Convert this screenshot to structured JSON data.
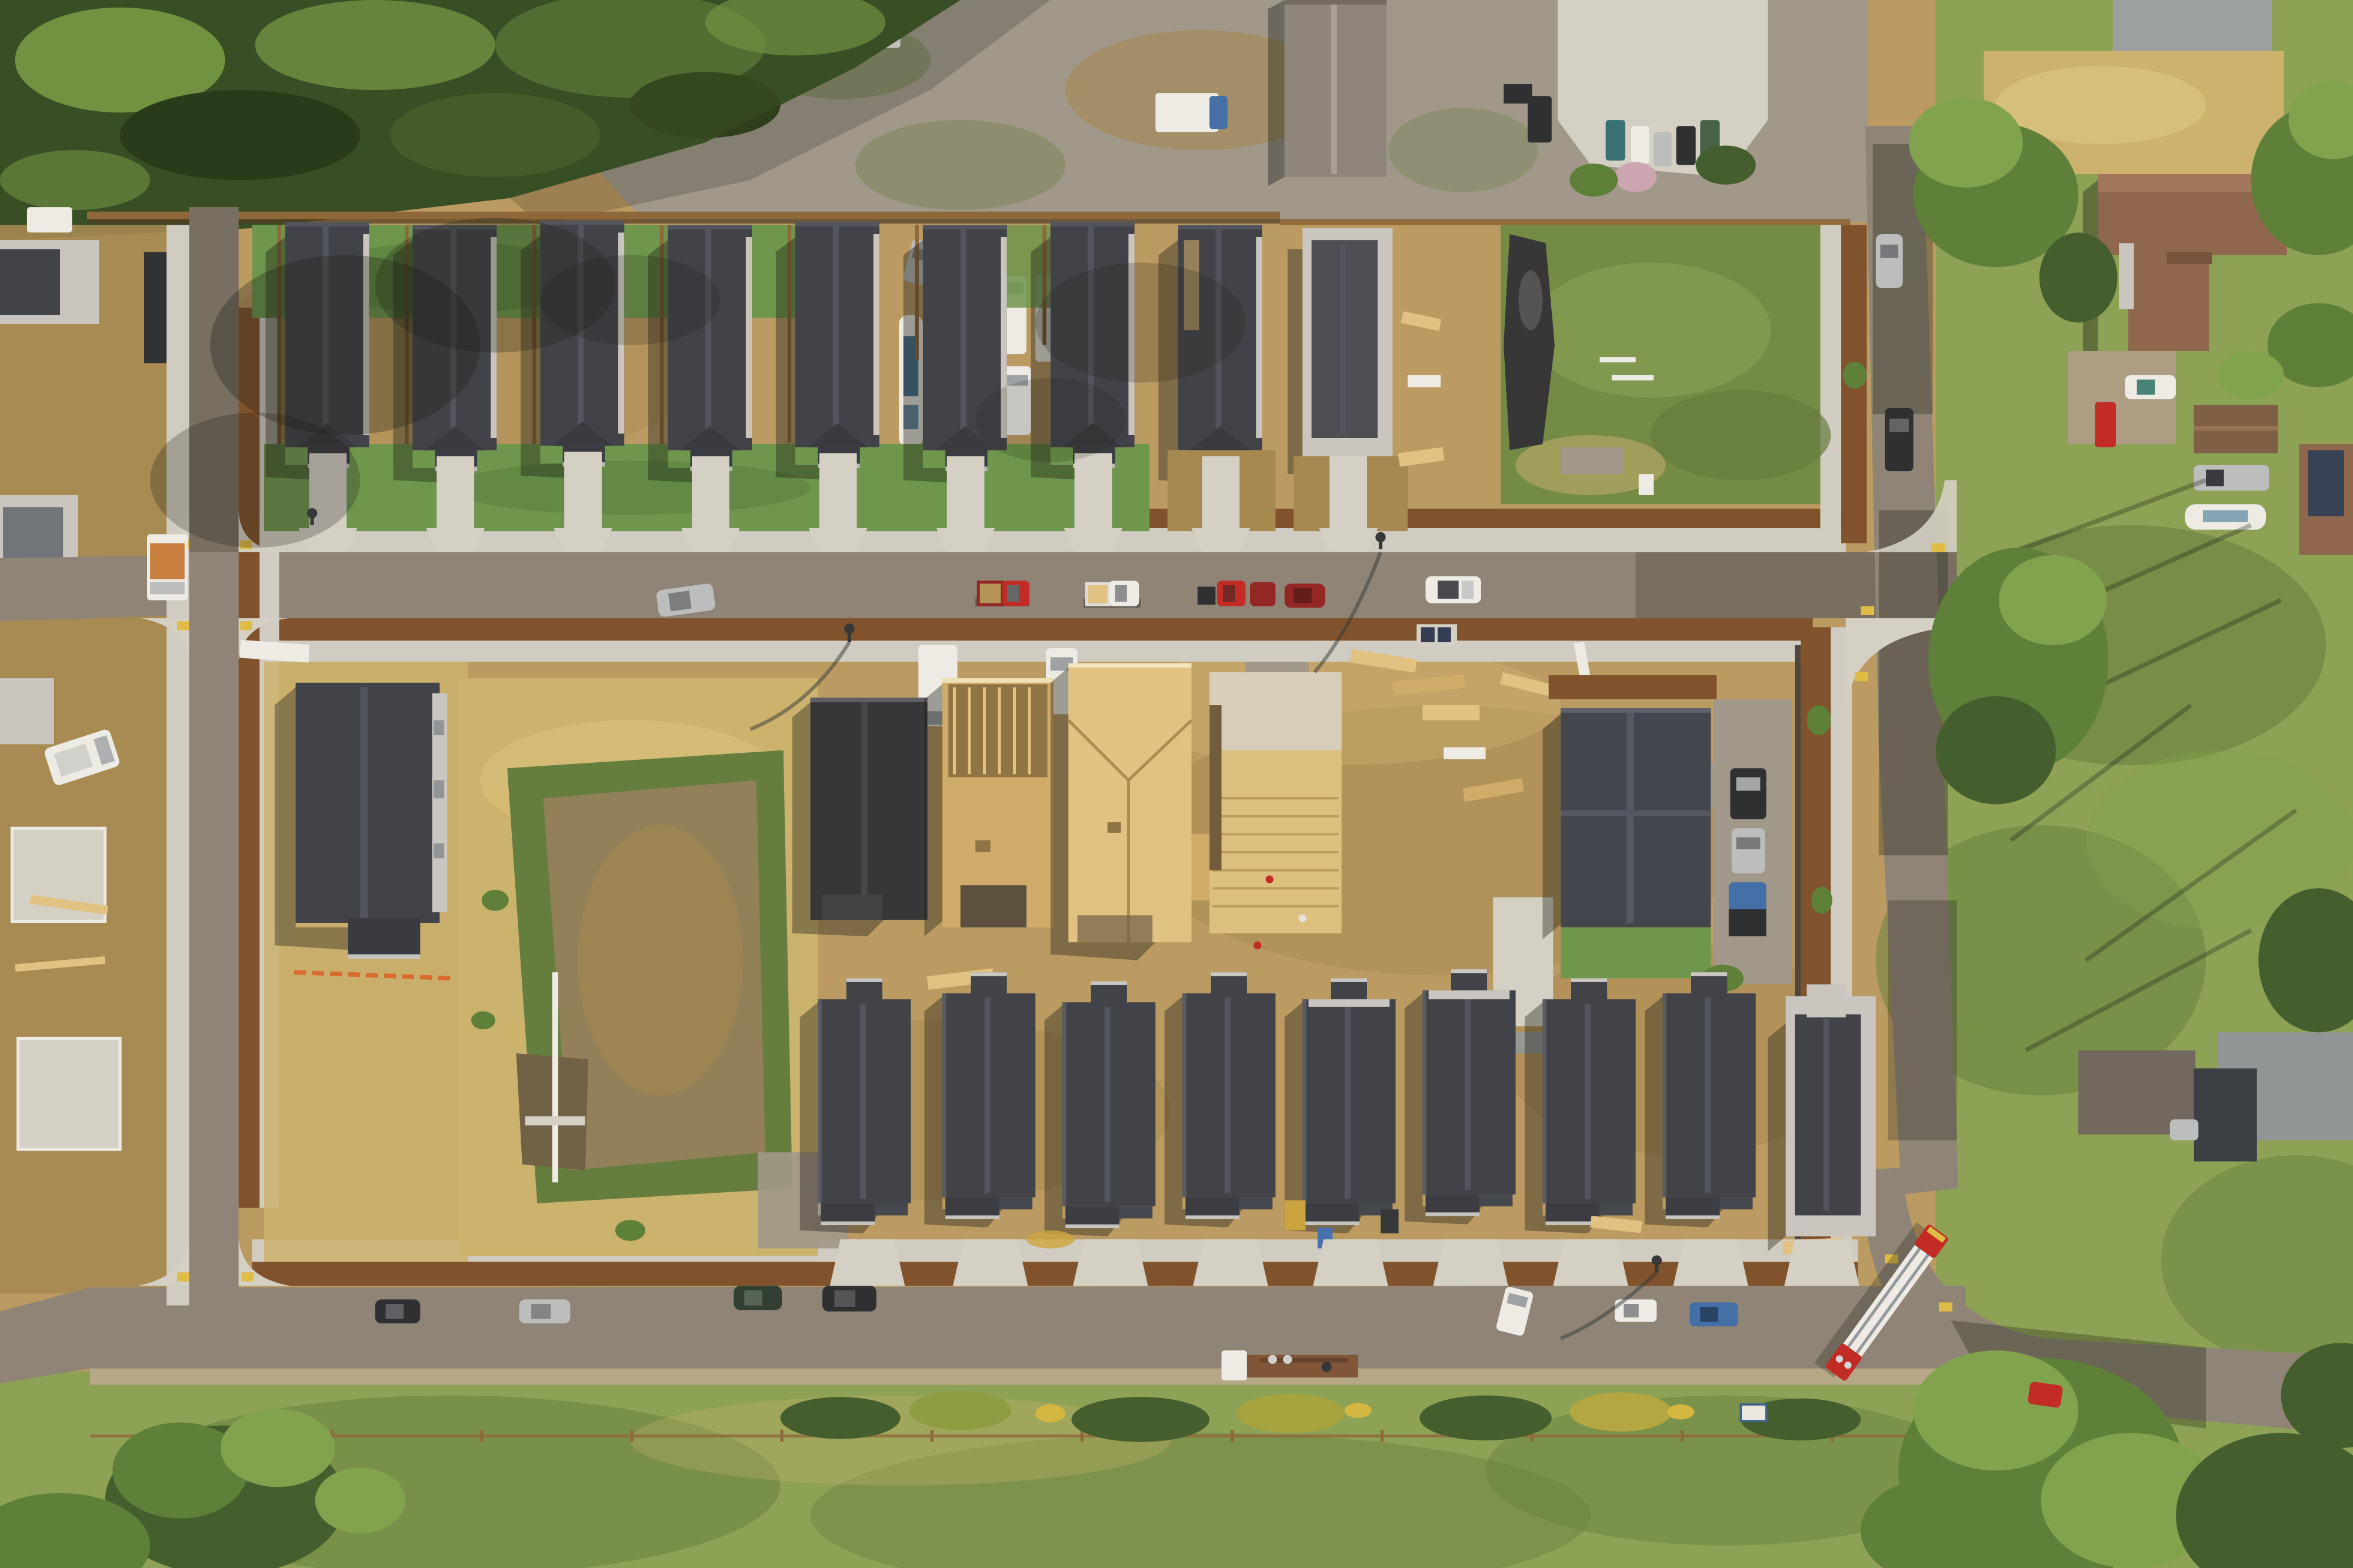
{
  "scene": {
    "description": "Top-down aerial drone photo of a new residential subdivision under construction. A loop of new streets encloses a top row of nine finished dark-charcoal-roof homes with green yards, a central dirt block with two plywood-framed houses, one felt-papered house, an open floor deck with lumber piles and workers, a large straw-colored retention basin lot with a model home, and a bottom row of nine dark-roof houses on bare dirt lots. Surroundings: conifer forest at top-left, a gravel contractor yard with vans and a boat at top-center, older rural homes among large trees on the right, and a green meadow strip across the bottom. A red fire ladder truck is parked on the curving east road.",
    "lighting": "bright morning sun, long shadows cast to the lower-left",
    "counts": {
      "finished_top_row_houses": 7,
      "top_row_houses_in_progress": 2,
      "bottom_row_houses": 9,
      "plywood_framed_houses": 2,
      "felt_papered_houses": 1,
      "open_floor_decks": 1,
      "completed_spec_homes_in_block": 2,
      "retention_basins": 1
    },
    "streets": {
      "main_street": "horizontal, upper third, parked trucks and cars",
      "bottom_street": "horizontal, lower third, parked cars and a semi flatbed",
      "left_street": "vertical, T-junctions at both ends",
      "right_road": "vertical under tree shadow, curves and exits bottom-right"
    },
    "vehicles": [
      {
        "type": "pickup-truck",
        "color": "red",
        "location": "main street"
      },
      {
        "type": "pickup-truck",
        "color": "white",
        "location": "main street"
      },
      {
        "type": "truck-and-car pair",
        "color": "red",
        "location": "main street"
      },
      {
        "type": "car",
        "color": "dark red",
        "location": "main street"
      },
      {
        "type": "suv",
        "color": "white",
        "location": "main street"
      },
      {
        "type": "suv",
        "color": "silver",
        "location": "main street west end"
      },
      {
        "type": "box-truck with graphics",
        "color": "white/orange",
        "location": "west street stub"
      },
      {
        "type": "sedan",
        "color": "black",
        "location": "bottom street"
      },
      {
        "type": "suv",
        "color": "silver",
        "location": "bottom street"
      },
      {
        "type": "wagon",
        "color": "dark green",
        "location": "bottom street"
      },
      {
        "type": "suv",
        "color": "black",
        "location": "bottom street"
      },
      {
        "type": "cargo-van",
        "color": "white",
        "location": "bottom street east"
      },
      {
        "type": "pickup-truck",
        "color": "white",
        "location": "bottom street east"
      },
      {
        "type": "pickup-truck",
        "color": "blue",
        "location": "bottom street east"
      },
      {
        "type": "semi-truck with rusty flatbed",
        "color": "white/brown",
        "location": "bottom street south side"
      },
      {
        "type": "fire-ladder-truck",
        "color": "red/white",
        "location": "east road curve"
      },
      {
        "type": "cargo-vans",
        "color": "white",
        "location": "gravel yard"
      },
      {
        "type": "boat-on-trailer",
        "color": "white/blue",
        "location": "gravel yard"
      },
      {
        "type": "box-truck",
        "color": "white, blue cab",
        "location": "gravel yard"
      },
      {
        "type": "car",
        "color": "silver",
        "location": "gravel yard"
      },
      {
        "type": "pickup-truck",
        "color": "dark",
        "location": "east road north"
      },
      {
        "type": "car",
        "color": "silver",
        "location": "east road north"
      },
      {
        "type": "pickup, car, truck",
        "color": "black/silver/blue",
        "location": "spec home gravel drive"
      },
      {
        "type": "pickup-truck and boat",
        "color": "silver/white",
        "location": "right-side yard"
      },
      {
        "type": "car",
        "color": "white-teal",
        "location": "rural driveway top-right"
      },
      {
        "type": "pickup-truck",
        "color": "red",
        "location": "rural driveway top-right"
      },
      {
        "type": "box-truck",
        "color": "white",
        "location": "construction block"
      },
      {
        "type": "pickup-truck",
        "color": "white",
        "location": "construction block"
      }
    ],
    "details": [
      "triangular brown mulch planters along sidewalks",
      "yellow tactile ramp pads at curb corners",
      "wood privacy fence behind top row",
      "orange construction fencing",
      "black plastic sheeting pile on vacant green lot",
      "lumber stacks and pallets",
      "workers on floor deck",
      "split-rail fence along bottom meadow",
      "retention pond with concrete outfall"
    ]
  },
  "palette": {
    "dirt": "#b8985f",
    "dirt-dark": "#a1854c",
    "straw": "#c9b06b",
    "basin": "#8d7c55",
    "water": "#6b5d42",
    "grass": "#87a052",
    "grass-dark": "#5e7937",
    "lawn": "#679348",
    "lawn-dark": "#4f7a38",
    "conifer": "#2e471f",
    "conifer-light": "#6a8f3d",
    "tree": "#567c34",
    "tree-light": "#7ba14a",
    "tree-dark": "#3c5827",
    "road": "#8a8073",
    "road-dark": "#5d564e",
    "gravel": "#9c958a",
    "concrete": "#d3d0c7",
    "sidewalk": "#cfccc3",
    "mulch": "#7a4c27",
    "fence": "#8a6234",
    "wall-light": "#c8c6c1",
    "roof": "#383c45",
    "roof-light": "#4a4f5b",
    "roof-felt": "#2d2f34",
    "roof-brown": "#8a6148",
    "roof-gray": "#979da0",
    "osb": "#cfa967",
    "osb-light": "#e0c182",
    "osb-dark": "#8a6f40",
    "white": "#ecece8",
    "silver": "#b9bcbf",
    "red": "#c0231f",
    "dark-red": "#8f1d1d",
    "blue": "#3a6aa8",
    "teal": "#2e6b72",
    "black": "#24272c",
    "yellow": "#ddbb41",
    "orange": "#d8672b",
    "shadow": "rgba(15,18,12,0.38)",
    "shade": "rgba(15,18,12,0.2)"
  }
}
